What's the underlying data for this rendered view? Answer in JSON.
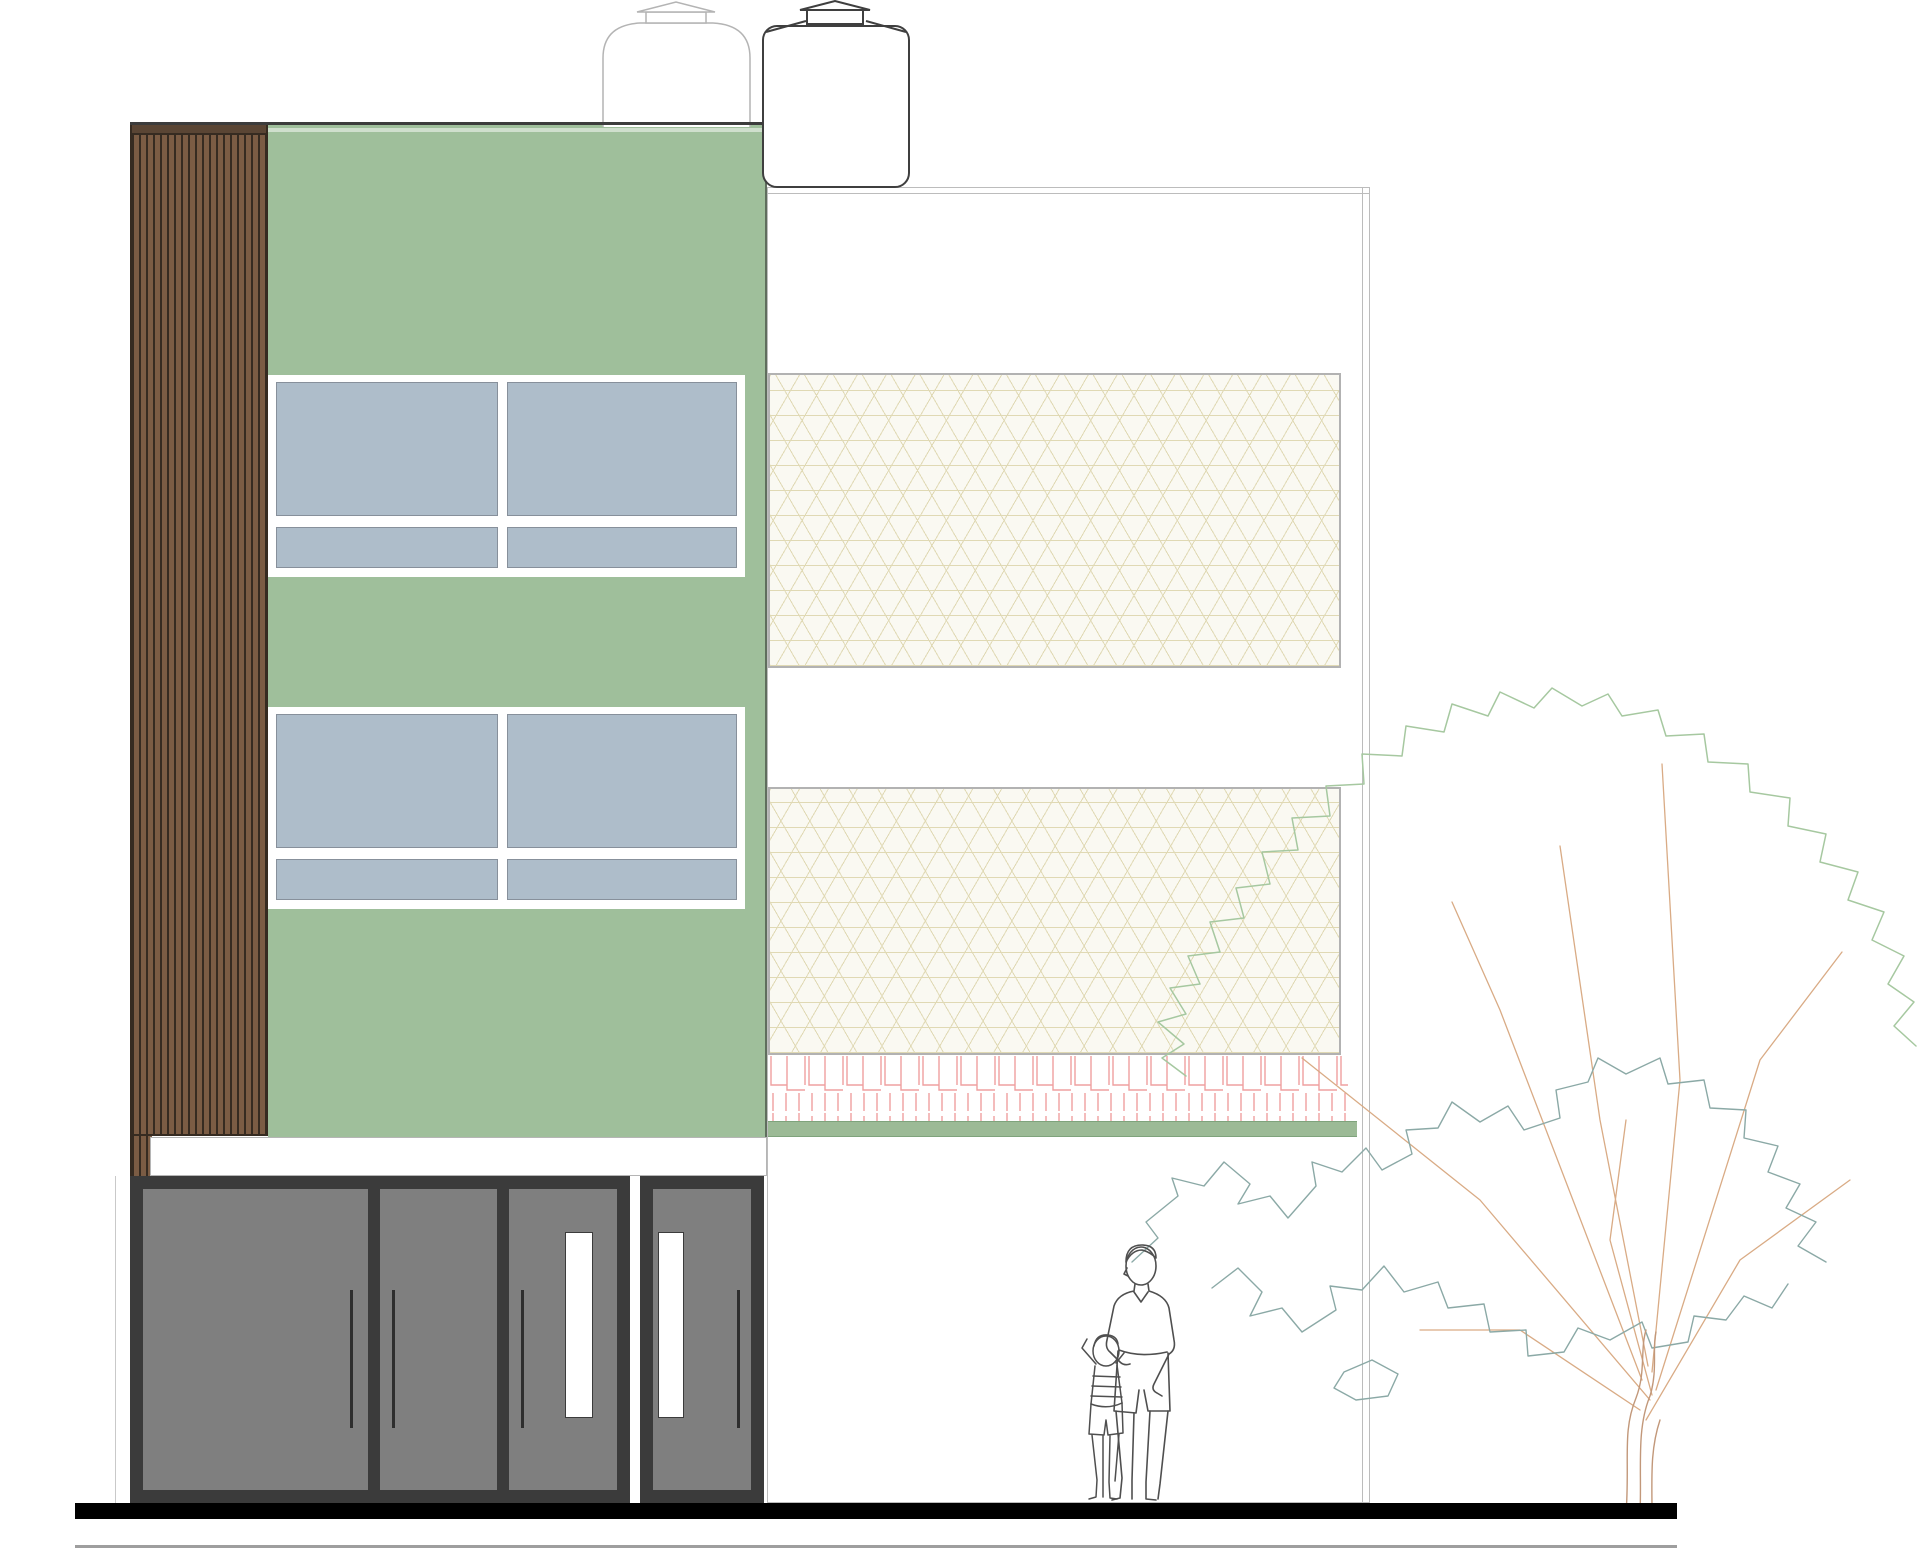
{
  "drawing": {
    "title": "building-front-elevation",
    "type": "architectural elevation drawing",
    "description": "Front elevation: wood-slat side panel, green facade with two window rows, white facade with two lattice screen panels and brick hatch course, ground-floor storefront with doors, two rooftop water tanks, scale figures (adult and child) and a tree"
  },
  "colors": {
    "canvas-bg": "#ffffff",
    "slat-base": "#7b5c44",
    "slat-line": "#362b21",
    "slat-cap": "#5a4534",
    "parapet": "#3c3c3c",
    "green-wall": "#9fbf9b",
    "green-edge": "#5f6e5d",
    "window-frame": "#ffffff",
    "glass": "#aebdca",
    "glass-edge": "#87909b",
    "building-outline": "#bcbcbc",
    "mesh-bg": "#faf9f2",
    "mesh-line": "#e0d9b4",
    "mesh-border": "#b2b2b2",
    "hatch": "#efa0a0",
    "band-green": "#9cba96",
    "band-green-edge": "#7fa37c",
    "slab-edge": "#b5b5b5",
    "door-frame": "#3b3b3b",
    "door-panel": "#7f7f7f",
    "handle": "#2e2e2e",
    "ground-bar": "#000000",
    "baseline": "#9e9e9e",
    "tank-light": "#b4b4b4",
    "tank-dark": "#3f3f3f",
    "figure-line": "#4f4f4f",
    "tree-outer": "#a6c8a0",
    "tree-inner": "#8ba9a6",
    "tree-branch": "#d9ab85",
    "tree-trunk": "#c2987a"
  },
  "left_panel": {
    "material": "vertical wood slats"
  },
  "green_facade": {
    "window_rows": 2,
    "panes_per_row": 4
  },
  "right_facade": {
    "screen_panels": 2,
    "hatch_rows": 2
  },
  "water_tanks": {
    "count": 2
  },
  "ground_floor": {
    "storefront_panels": 3,
    "glass_slot_doors": 2,
    "handles": 4
  },
  "figures": {
    "adult": 1,
    "child": 1
  },
  "tree": {
    "count": 1
  }
}
